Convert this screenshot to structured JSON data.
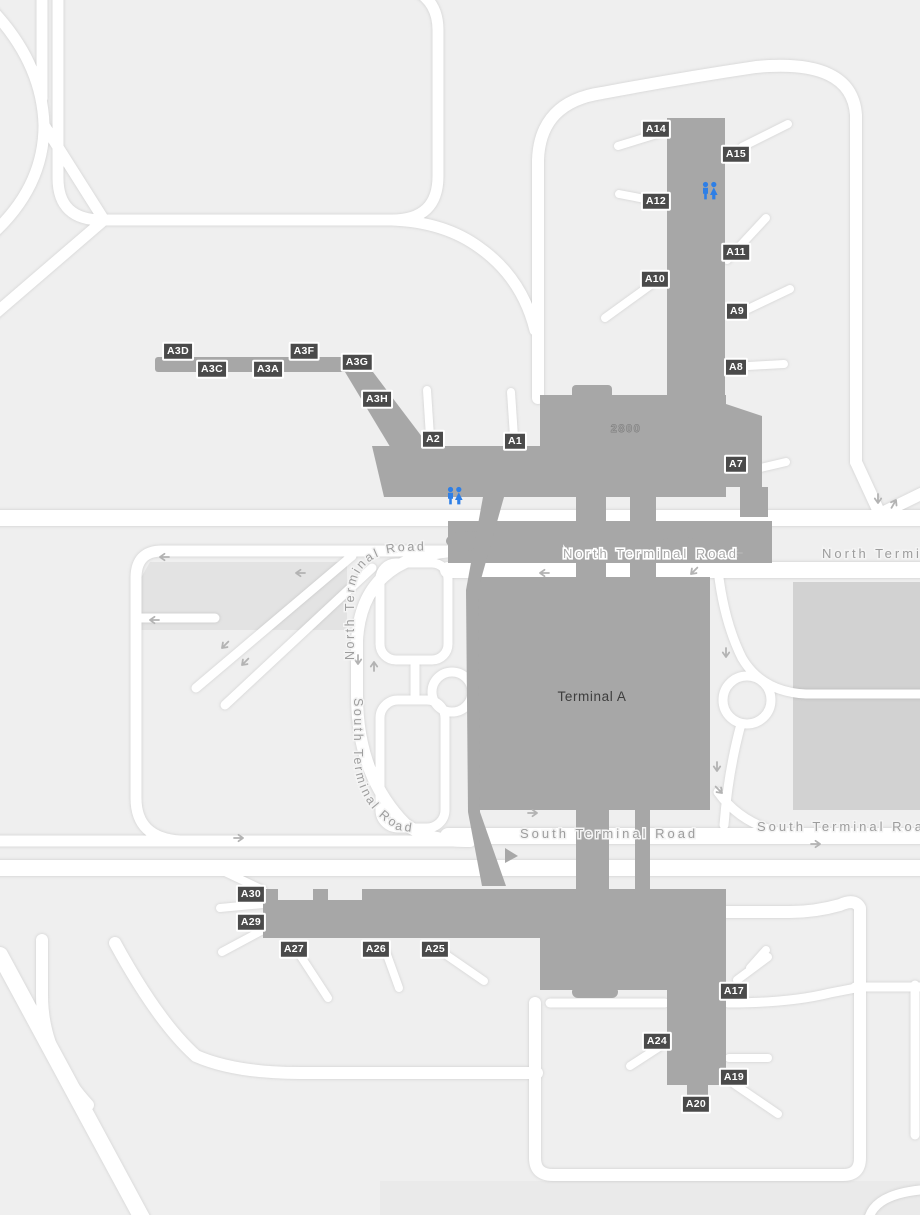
{
  "map": {
    "terminal_label": "Terminal A",
    "building_number": "2800",
    "roads": {
      "north": "North Terminal Road",
      "south": "South Terminal Road"
    },
    "gates": [
      {
        "id": "A14",
        "x": 656,
        "y": 129
      },
      {
        "id": "A15",
        "x": 736,
        "y": 154
      },
      {
        "id": "A12",
        "x": 656,
        "y": 201
      },
      {
        "id": "A11",
        "x": 736,
        "y": 252
      },
      {
        "id": "A10",
        "x": 655,
        "y": 279
      },
      {
        "id": "A9",
        "x": 737,
        "y": 311
      },
      {
        "id": "A8",
        "x": 736,
        "y": 367
      },
      {
        "id": "A7",
        "x": 736,
        "y": 464
      },
      {
        "id": "A1",
        "x": 515,
        "y": 441
      },
      {
        "id": "A2",
        "x": 433,
        "y": 439
      },
      {
        "id": "A3D",
        "x": 178,
        "y": 351
      },
      {
        "id": "A3C",
        "x": 212,
        "y": 369
      },
      {
        "id": "A3A",
        "x": 268,
        "y": 369
      },
      {
        "id": "A3F",
        "x": 304,
        "y": 351
      },
      {
        "id": "A3G",
        "x": 357,
        "y": 362
      },
      {
        "id": "A3H",
        "x": 377,
        "y": 399
      },
      {
        "id": "A30",
        "x": 251,
        "y": 894
      },
      {
        "id": "A29",
        "x": 251,
        "y": 922
      },
      {
        "id": "A27",
        "x": 294,
        "y": 949
      },
      {
        "id": "A26",
        "x": 376,
        "y": 949
      },
      {
        "id": "A25",
        "x": 435,
        "y": 949
      },
      {
        "id": "A17",
        "x": 734,
        "y": 991
      },
      {
        "id": "A24",
        "x": 657,
        "y": 1041
      },
      {
        "id": "A19",
        "x": 734,
        "y": 1077
      },
      {
        "id": "A20",
        "x": 696,
        "y": 1104
      }
    ],
    "restrooms": [
      {
        "x": 711,
        "y": 191,
        "area": "north-pier"
      },
      {
        "x": 456,
        "y": 496,
        "area": "west-concourse"
      }
    ],
    "colors": {
      "background": "#efefef",
      "road": "#ffffff",
      "building": "#a7a7a7",
      "parking_garage": "#d2d2d2",
      "parking_lot": "#e3e3e3",
      "gate_label_bg": "#4a4a4a",
      "gate_label_text": "#ffffff",
      "road_label_text": "#9d9d9d",
      "restroom_icon": "#2e7fe6"
    }
  }
}
